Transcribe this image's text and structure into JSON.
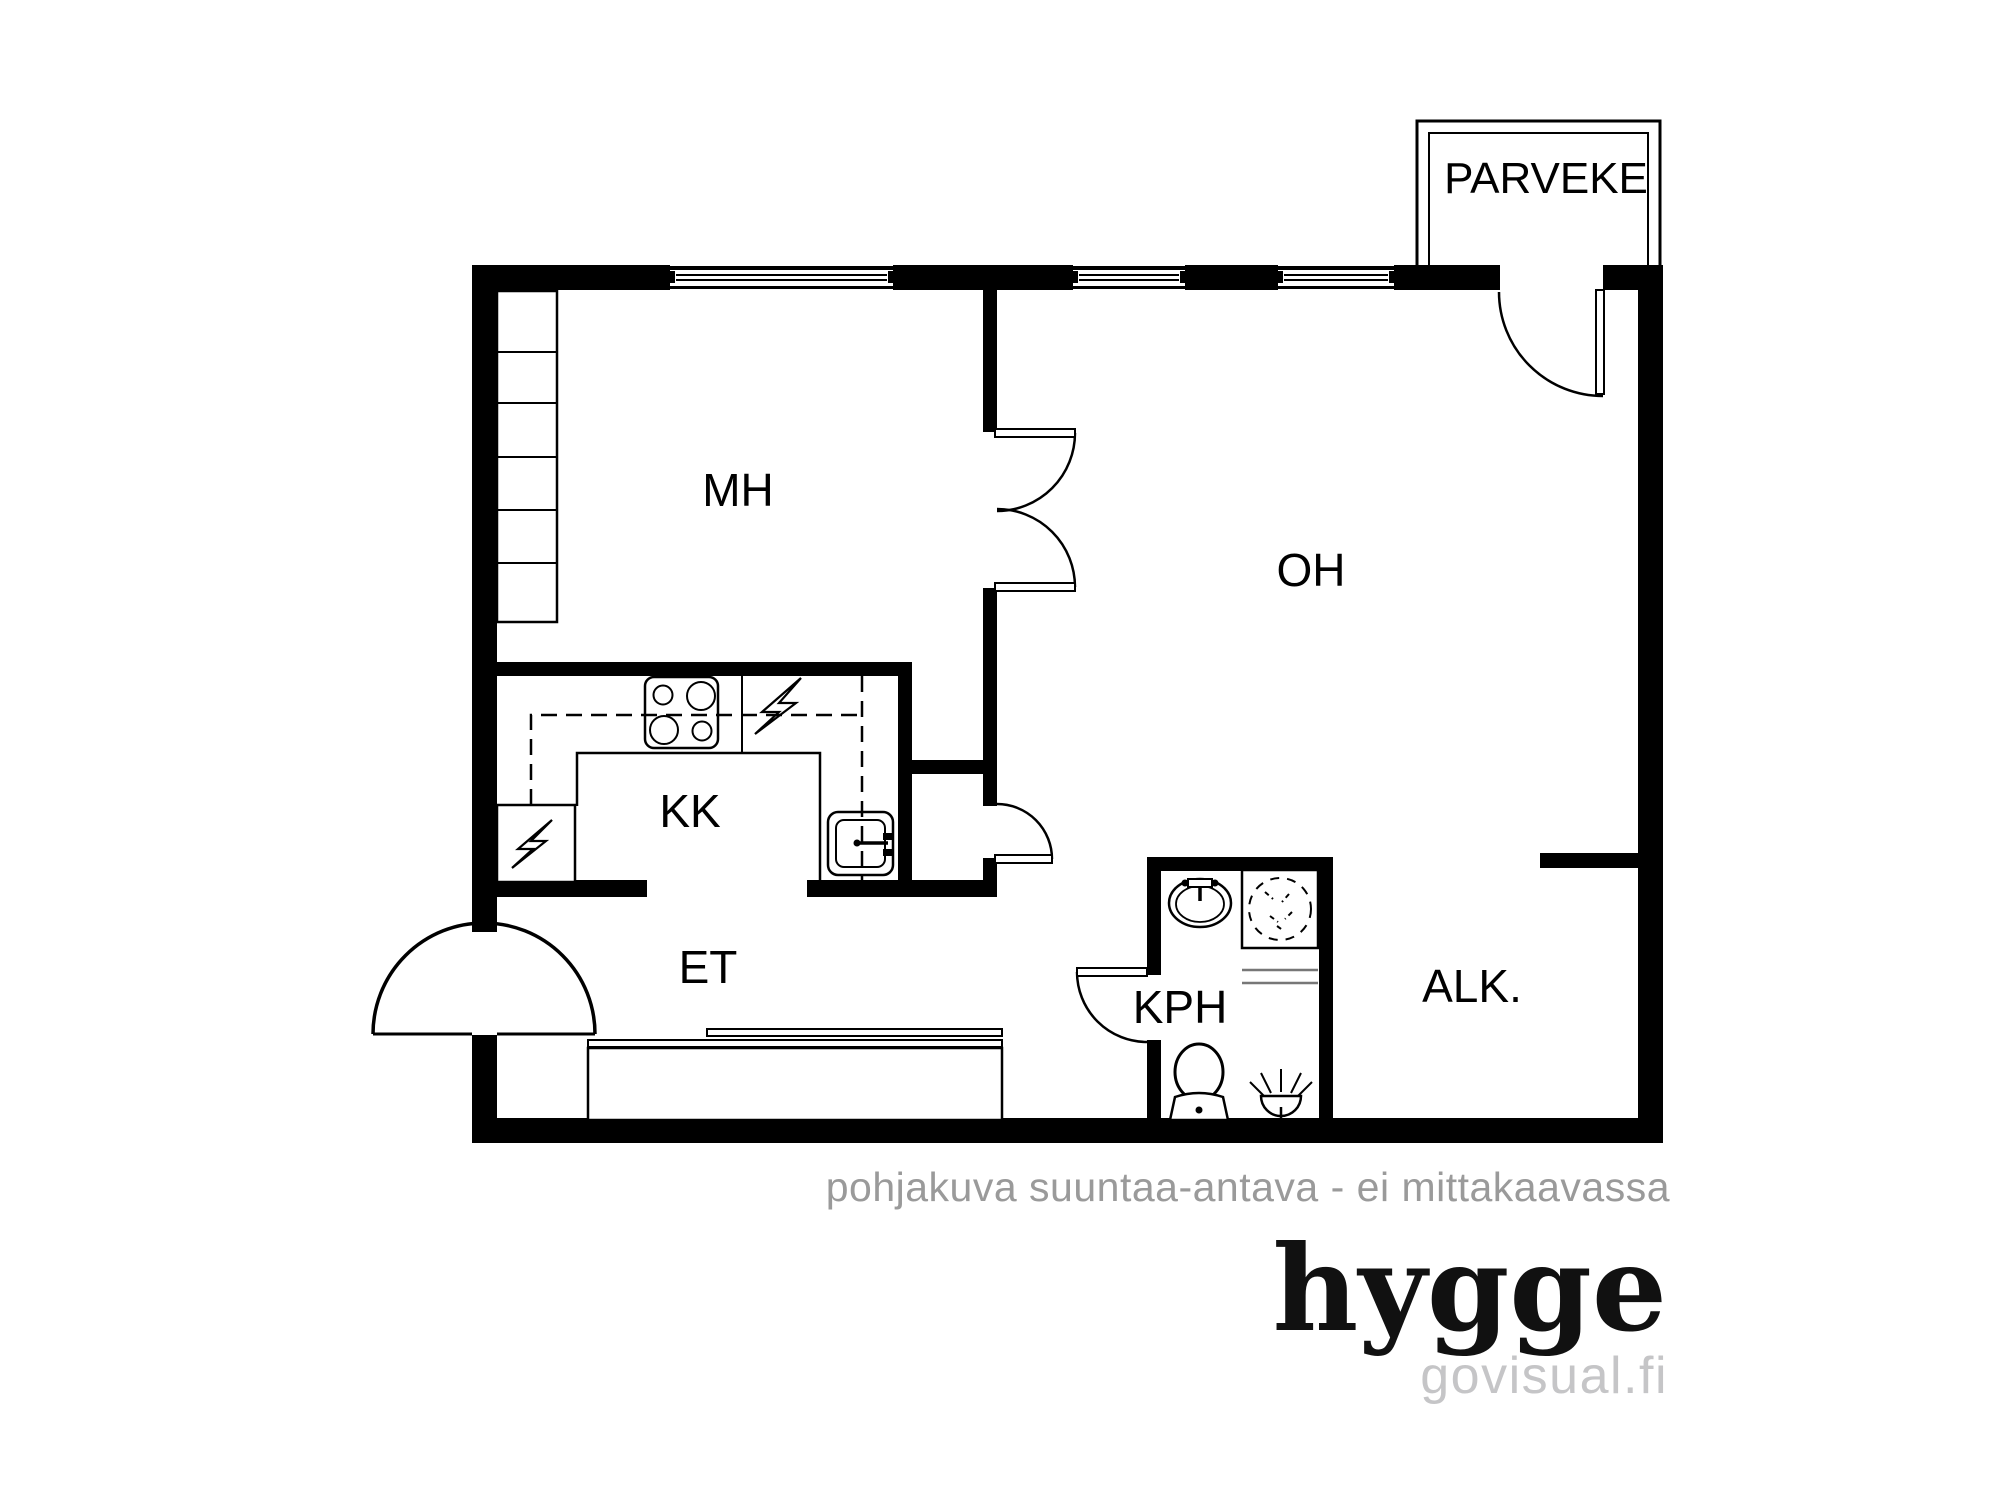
{
  "floorplan": {
    "rooms": [
      {
        "id": "mh",
        "label": "MH"
      },
      {
        "id": "oh",
        "label": "OH"
      },
      {
        "id": "kk",
        "label": "KK"
      },
      {
        "id": "et",
        "label": "ET"
      },
      {
        "id": "kph",
        "label": "KPH"
      },
      {
        "id": "alk",
        "label": "ALK."
      }
    ],
    "balcony": {
      "label": "PARVEKE"
    },
    "caption": "pohjakuva suuntaa-antava - ei mittakaavassa",
    "brand": {
      "name": "hygge",
      "website": "govisual.fi"
    },
    "colors": {
      "walls": "#000000",
      "background": "#ffffff",
      "caption_gray": "#9a9a9a",
      "website_gray": "#c5c5c7"
    }
  }
}
